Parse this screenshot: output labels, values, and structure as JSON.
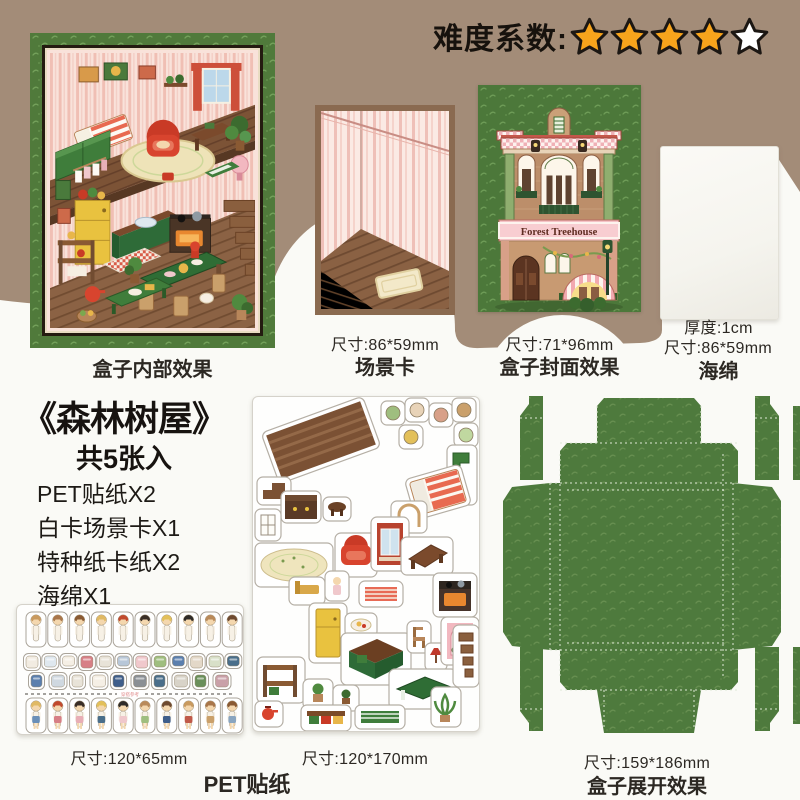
{
  "difficulty": {
    "label": "难度系数:",
    "stars_total": 5,
    "stars_filled": 4
  },
  "gallery": {
    "interior": {
      "caption": "盒子内部效果"
    },
    "scene": {
      "size": "尺寸:86*59mm",
      "caption": "场景卡"
    },
    "cover": {
      "size": "尺寸:71*96mm",
      "caption": "盒子封面效果",
      "banner": "Forest Treehouse"
    },
    "sponge": {
      "thickness": "厚度:1cm",
      "size": "尺寸:86*59mm",
      "caption": "海绵"
    }
  },
  "product": {
    "title": "《森林树屋》",
    "subtitle": "共5张入",
    "contents": [
      "PET贴纸X2",
      "白卡场景卡X1",
      "特种纸卡纸X2",
      "海绵X1"
    ]
  },
  "sheets": {
    "small": {
      "size": "尺寸:120*65mm",
      "divider_label": "穿搭参考"
    },
    "large": {
      "size": "尺寸:120*170mm"
    },
    "group_caption": "PET贴纸",
    "box": {
      "size": "尺寸:159*186mm",
      "caption": "盒子展开效果"
    }
  },
  "colors": {
    "band_brown": "#a38c78",
    "green": "#4f7a3b",
    "star_orange": "#f7a41c",
    "star_empty": "#ffffff",
    "card_border": "#8a6a50"
  }
}
